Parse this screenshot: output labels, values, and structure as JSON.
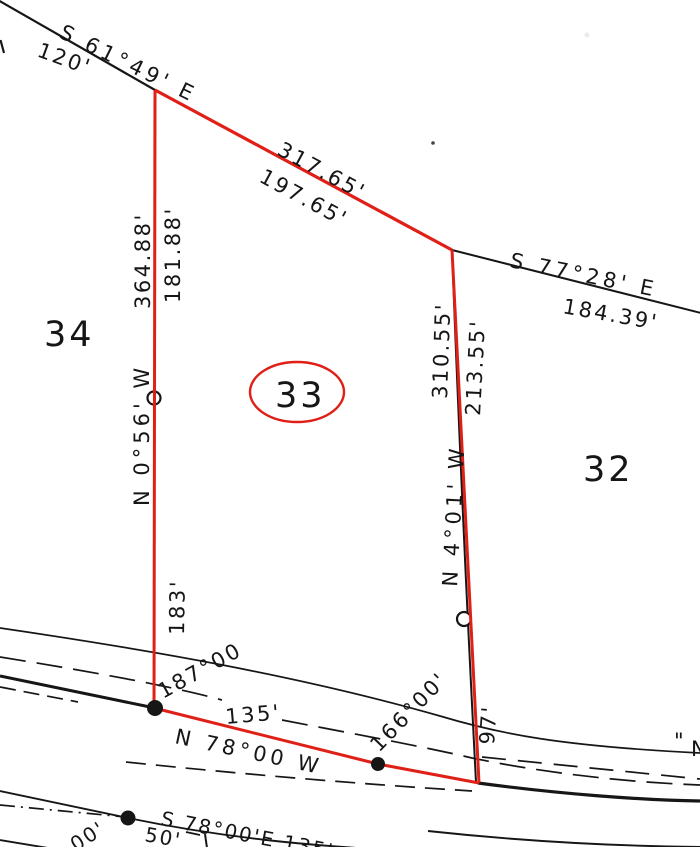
{
  "parcels": {
    "p34": "34",
    "p33": "33",
    "p32": "32"
  },
  "boundary_labels": {
    "nw_bearing": "S 61°49' E",
    "nw_distance": "120'",
    "north_total": "317.65'",
    "north_part": "197.65'",
    "ne_bearing": "S 77°28' E",
    "ne_distance": "184.39'",
    "west_total": "364.88'",
    "west_part": "181.88'",
    "west_bearing": "N 0°56' W",
    "west_lower": "183'",
    "east_total": "310.55'",
    "east_part": "213.55'",
    "east_bearing": "N 4°01' W",
    "east_lower": "97'"
  },
  "road_labels": {
    "angle_west": "187°00",
    "frontage": "135'",
    "road_bearing": "N 78°00 W",
    "angle_east": "166°00'",
    "south_line": "S 78°00'E  135'",
    "offset": "50'",
    "partial_sw": "00'",
    "partial_w_edge": "5'",
    "quote_ne": "\"",
    "partial_letter_ne": "N"
  },
  "colors": {
    "parcel_red": "#e01f17",
    "ink": "#161616",
    "paper": "#ffffff"
  }
}
